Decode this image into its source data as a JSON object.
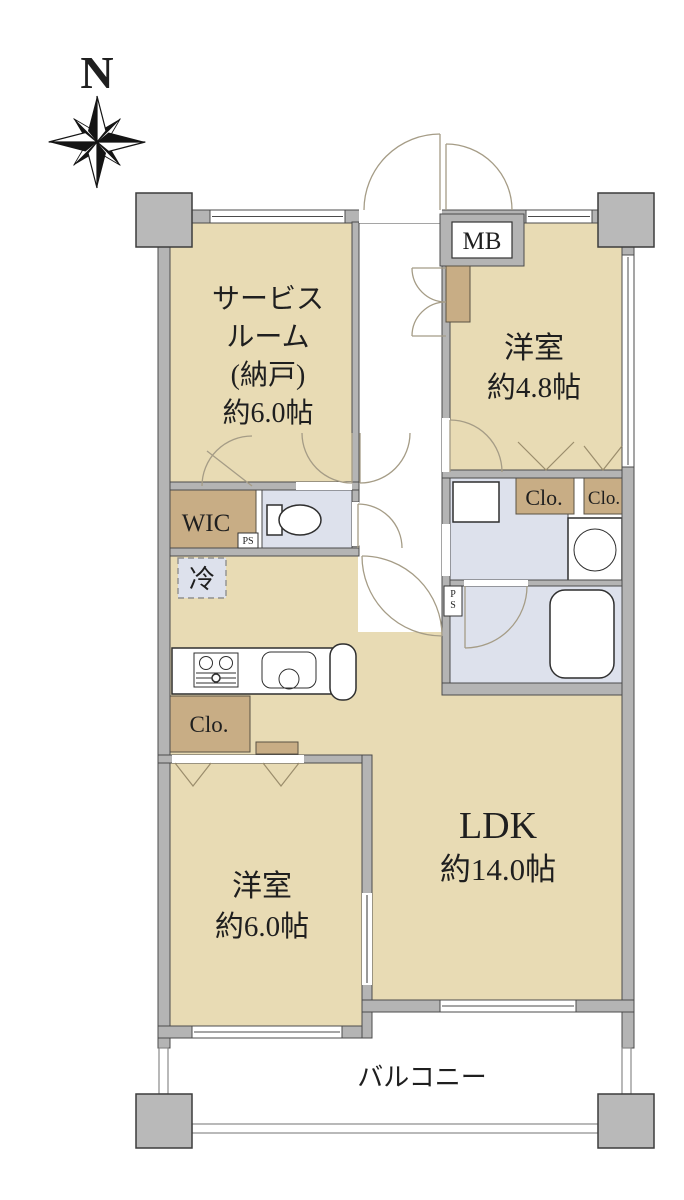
{
  "compass": {
    "label": "N"
  },
  "colors": {
    "room": "#e8dbb4",
    "closet": "#c8ad85",
    "wet": "#dde1ec",
    "wall": "#b4b4b4",
    "pillar": "#b9b9b9"
  },
  "rooms": {
    "service": {
      "line1": "サービス",
      "line2": "ルーム",
      "line3": "(納戸)",
      "size": "約6.0帖"
    },
    "west48": {
      "name": "洋室",
      "size": "約4.8帖"
    },
    "ldk": {
      "name": "LDK",
      "size": "約14.0帖"
    },
    "west60": {
      "name": "洋室",
      "size": "約6.0帖"
    },
    "balcony": {
      "name": "バルコニー"
    }
  },
  "labels": {
    "meter_box": "MB",
    "wic": "WIC",
    "pipe_space": "PS",
    "refrigerator": "冷",
    "closet": "Clo."
  }
}
